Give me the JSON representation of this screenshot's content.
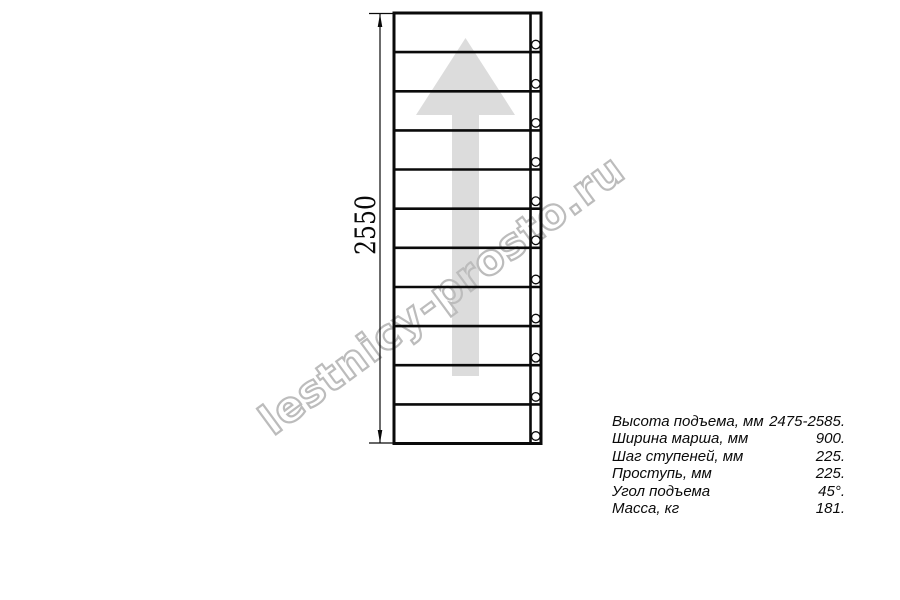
{
  "drawing": {
    "dimension_height_label": "2550",
    "tread_count": 11,
    "baluster_count": 11,
    "direction_arrow": "up-arrow"
  },
  "watermark": {
    "text": "lestnicy-prosto.ru"
  },
  "specs": {
    "rows": [
      {
        "label": "Высота подъема, мм",
        "value": "2475-2585."
      },
      {
        "label": "Ширина марша, мм",
        "value": "900."
      },
      {
        "label": "Шаг ступеней, мм",
        "value": "225."
      },
      {
        "label": "Проступь, мм",
        "value": "225."
      },
      {
        "label": "Угол подъема",
        "value": "45°."
      },
      {
        "label": "Масса, кг",
        "value": "181."
      }
    ]
  },
  "colors": {
    "line": "#0a0a0a",
    "direction_arrow": "#dcdcdc",
    "watermark_outline": "#bcbcbc"
  }
}
